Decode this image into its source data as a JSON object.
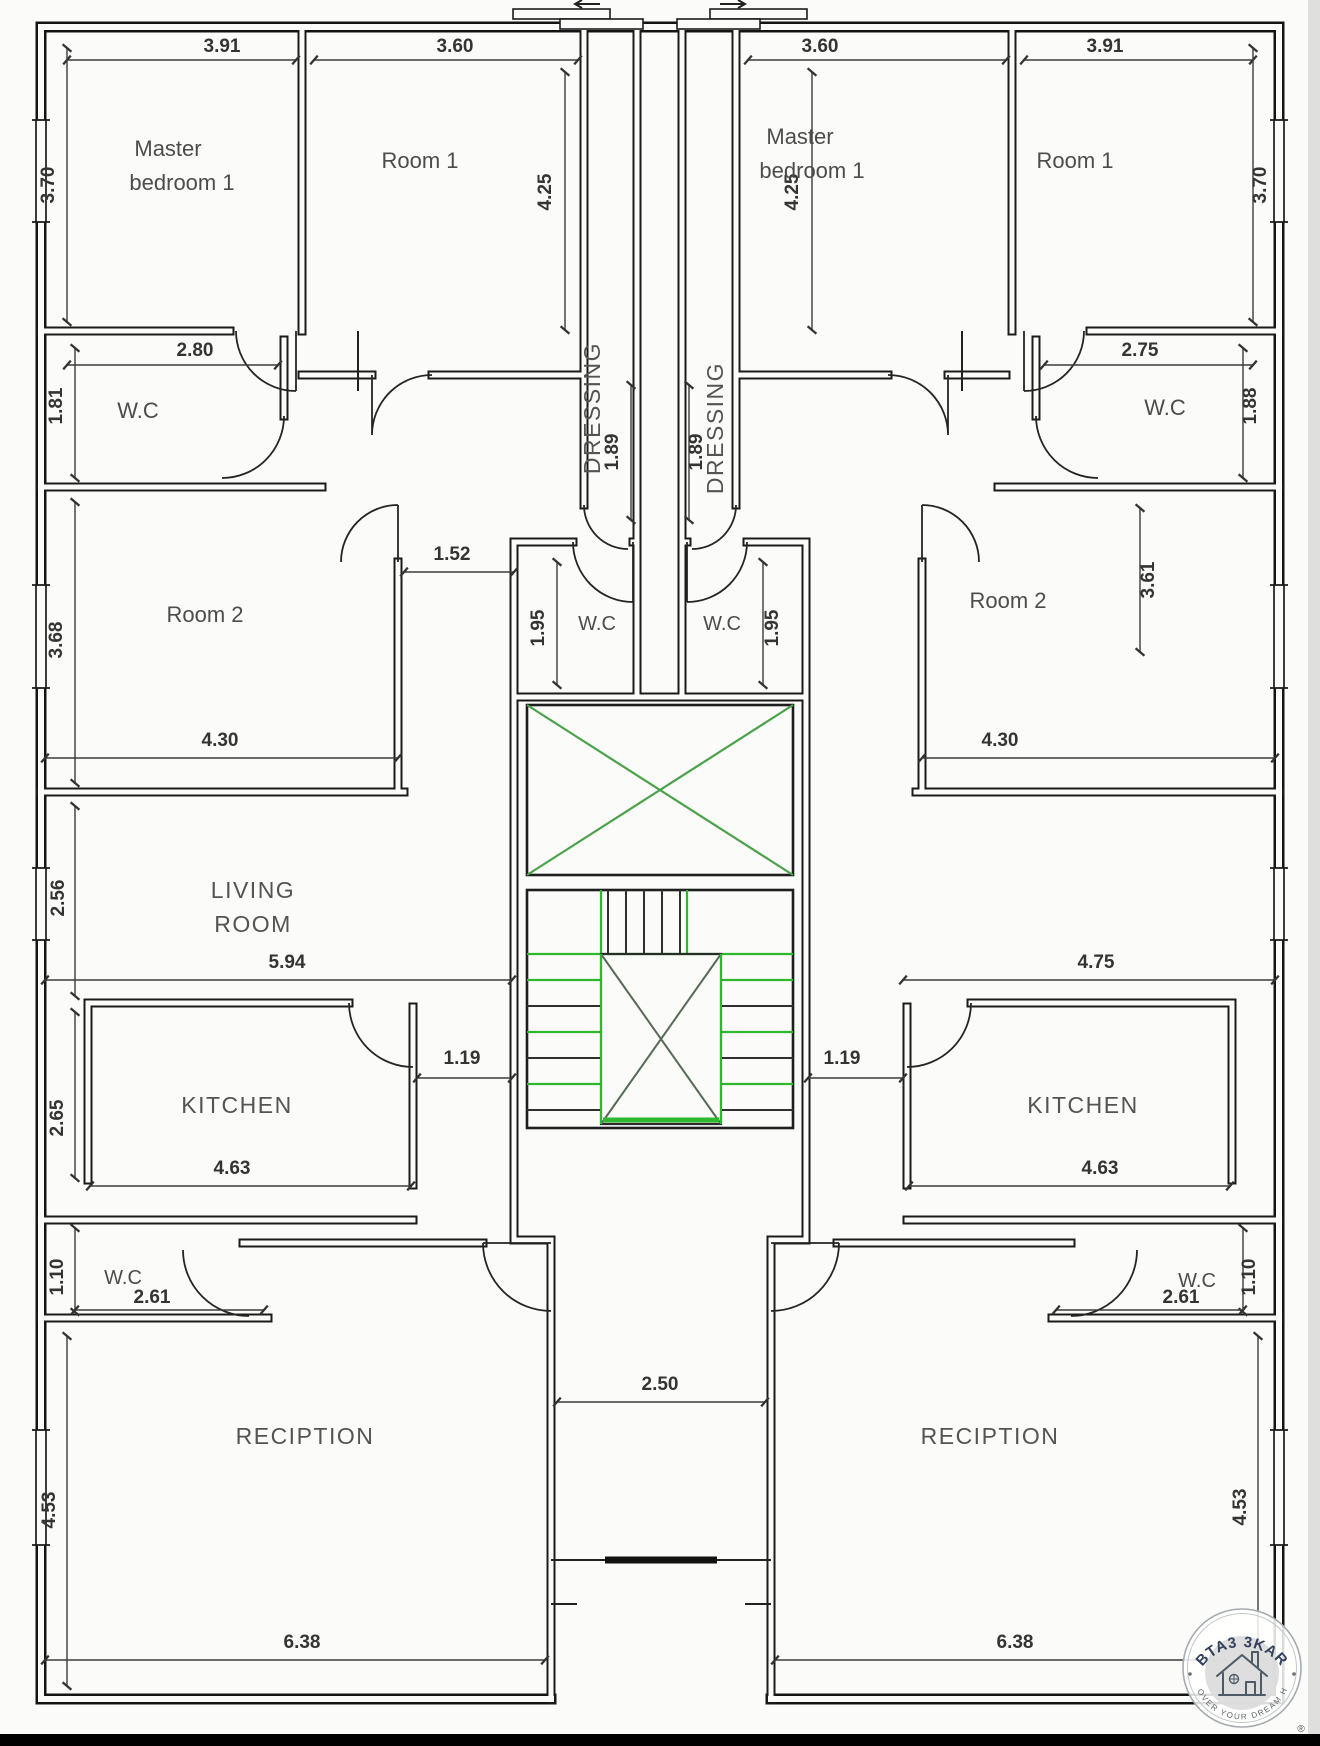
{
  "units": {
    "left": {
      "labels": {
        "master_l1": "Master",
        "master_l2": "bedroom 1",
        "room1": "Room 1",
        "wc_top": "W.C",
        "dressing": "DRESSING",
        "room2": "Room 2",
        "wc_core": "W.C",
        "living_l1": "LIVING",
        "living_l2": "ROOM",
        "kitchen": "KITCHEN",
        "wc_bottom": "W.C",
        "reception": "RECIPTION"
      },
      "dims": {
        "master_w": "3.91",
        "master_h": "3.70",
        "room1_w": "3.60",
        "room1_h": "4.25",
        "wc_top_w": "2.80",
        "wc_top_h": "1.81",
        "dressing_len": "1.89",
        "hall_w": "1.52",
        "wc_core_h": "1.95",
        "room2_w": "4.30",
        "room2_h": "3.68",
        "living_w": "5.94",
        "living_h": "2.56",
        "kitchen_w": "4.63",
        "kitchen_h": "2.65",
        "passage": "1.19",
        "wc_bottom_w": "2.61",
        "wc_bottom_h": "1.10",
        "reception_w": "6.38",
        "reception_h": "4.53"
      }
    },
    "right": {
      "labels": {
        "master_l1": "Master",
        "master_l2": "bedroom 1",
        "room1": "Room 1",
        "wc_top": "W.C",
        "dressing": "DRESSING",
        "room2": "Room 2",
        "wc_core": "W.C",
        "kitchen": "KITCHEN",
        "wc_bottom": "W.C",
        "reception": "RECIPTION"
      },
      "dims": {
        "master_w": "3.60",
        "master_h": "4.25",
        "room1_w": "3.91",
        "room1_h": "3.70",
        "wc_top_w": "2.75",
        "wc_top_h": "1.88",
        "dressing_len": "1.89",
        "wc_core_h": "1.95",
        "room2_w": "4.30",
        "room2_h": "3.61",
        "living_w": "4.75",
        "kitchen_w": "4.63",
        "passage": "1.19",
        "wc_bottom_w": "2.61",
        "wc_bottom_h": "1.10",
        "reception_w": "6.38",
        "reception_h": "4.53"
      }
    }
  },
  "core": {
    "corridor_w": "2.50"
  },
  "colors": {
    "stair_green": "#2eb82e",
    "elevator_cross_green": "#4aa34a",
    "wall": "#1b1b1b",
    "dim_text": "#343434",
    "watermark_brand": "#33415c"
  },
  "watermark": {
    "brand": "BTA3 3KAR",
    "tagline": "DISCOVER YOUR DREAM HOME",
    "registered": "®"
  }
}
